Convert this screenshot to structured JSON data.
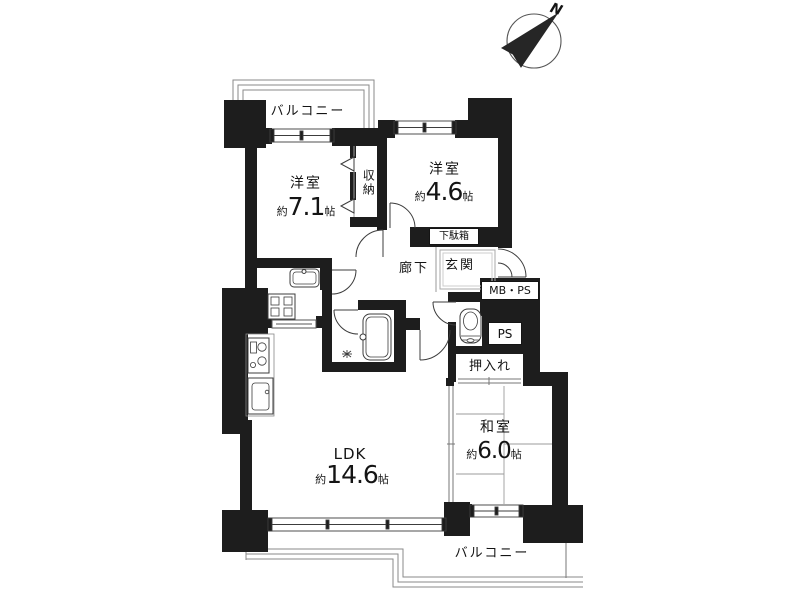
{
  "title": "間取り図",
  "colors": {
    "wall": "#1d1d1d",
    "outline": "#3c3c3c",
    "rail": "#8a8a8a",
    "tatami_line": "#9b9b9b",
    "background": "#ffffff",
    "text": "#141414"
  },
  "compass": {
    "label": "N",
    "icon": "compass-north-arrow-icon"
  },
  "rooms": {
    "balcony_top": {
      "label": "バルコニー"
    },
    "western_room_1": {
      "name": "洋室",
      "size_prefix": "約",
      "size_value": "7.1",
      "size_unit": "帖"
    },
    "storage": {
      "label": "収納"
    },
    "western_room_2": {
      "name": "洋室",
      "size_prefix": "約",
      "size_value": "4.6",
      "size_unit": "帖"
    },
    "shoe_cabinet": {
      "label": "下駄箱"
    },
    "entrance": {
      "label": "玄関"
    },
    "hallway": {
      "label": "廊下"
    },
    "meter_pipe_space": {
      "label": "MB・PS"
    },
    "pipe_space": {
      "label": "PS"
    },
    "closet": {
      "label": "押入れ"
    },
    "japanese_room": {
      "name": "和室",
      "size_prefix": "約",
      "size_value": "6.0",
      "size_unit": "帖"
    },
    "ldk": {
      "name": "LDK",
      "size_prefix": "約",
      "size_value": "14.6",
      "size_unit": "帖"
    },
    "balcony_bottom": {
      "label": "バルコニー"
    }
  },
  "fixtures": {
    "bathtub": "bathtub-icon",
    "shower": "shower-head-icon",
    "toilet": "toilet-icon",
    "washbasin": "washbasin-icon",
    "washing_machine_pan": "washing-machine-pan-icon",
    "stove": "gas-stove-icon",
    "kitchen_sink": "kitchen-sink-icon"
  }
}
